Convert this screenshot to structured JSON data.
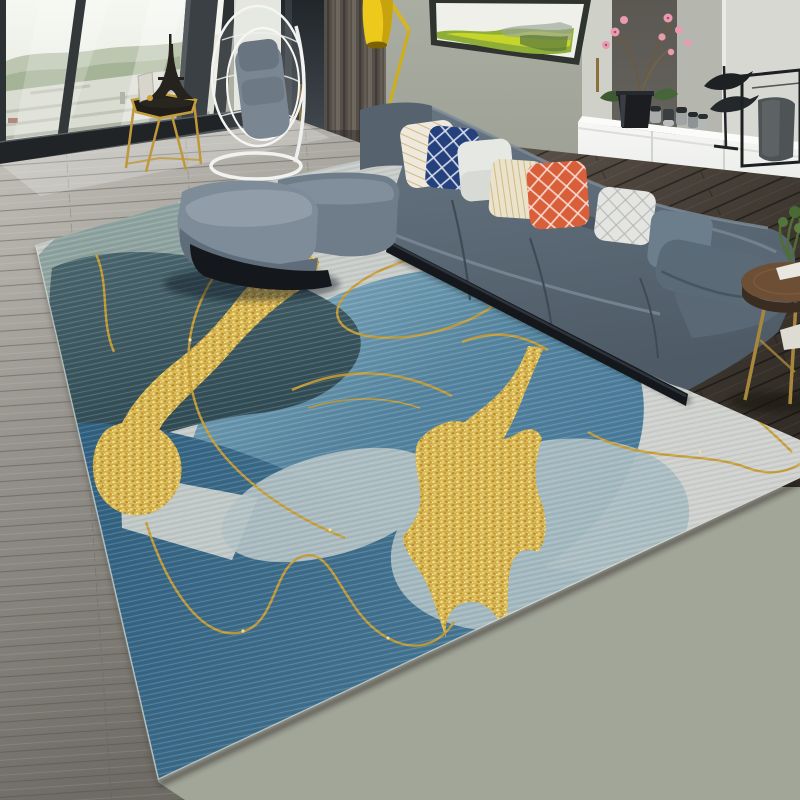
{
  "meta": {
    "title": "Living room product photo — abstract blue and gold area rug",
    "description": "Photographic scene: grey L-shaped sectional sofa on a diagonal abstract rug, floor-to-ceiling window with city view, white sideboard, yellow floor lamp, hanging egg chair"
  },
  "scene": {
    "objects": [
      "window city view",
      "gold hexagonal side table",
      "eiffel tower figurine",
      "hanging egg chair",
      "dark curtain",
      "yellow floor lamp",
      "wall art canvas",
      "white sideboard",
      "pink orchid",
      "ceramic cups",
      "bird sculpture",
      "metal cube vase stand",
      "grey sectional sofa",
      "throw pillows",
      "chaise cushions",
      "round walnut side table",
      "abstract area rug",
      "grey wood floor",
      "dark wood floor"
    ],
    "counts": {
      "throw_pillows": 8,
      "cups_on_sideboard": 5,
      "bird_figurines": 2,
      "window_mullions": 3,
      "chaise_cushions": 2
    }
  },
  "rug": {
    "style": "abstract modern",
    "shapes": [
      "sage blob",
      "dark teal blob",
      "azure circle",
      "pale lens",
      "bright wedge",
      "pale disc",
      "deep blue field"
    ],
    "accents": [
      "glitter gold ribbon",
      "glitter gold star",
      "thin gold script lines"
    ]
  },
  "palette": {
    "wall": "#a4a89b",
    "wall_stripe_dark": "#6e695f",
    "wall_stripe_light": "#b5b7ae",
    "wall_panel_bright": "#d7d8d2",
    "door_white": "#cfd1c9",
    "curtain": "#55504a",
    "lamp_yellow": "#edc91c",
    "cabinet_white": "#f2f3f1",
    "sofa_base": "#5d6b79",
    "sofa_shadow": "#46525e",
    "sofa_highlight": "#82909d",
    "plinth_black": "#14171b",
    "chaise_top": "#7e8c99",
    "pillow_white": "#eee9dc",
    "pillow_navy": "#24407d",
    "pillow_grey": "#e6e8e4",
    "pillow_cream": "#eae2ca",
    "pillow_coral": "#d95f3a",
    "pillow_slate": "#6c7d8c",
    "pillow_lumbar": "#5a6a77",
    "rug_base": "#c8ccc9",
    "rug_sage": "#8ea39f",
    "rug_azure": "#5a8aa4",
    "rug_teal": "#3d5a63",
    "rug_deep_blue": "#32617f",
    "rug_pale": "#a9bdc2",
    "rug_wedge": "#ccd1cd",
    "gold_glitter": "#d7b34c",
    "gold_line": "#c79d35",
    "floor_light": "#9b9894",
    "floor_dark": "#4a423c",
    "table_wood": "#6d4f35",
    "metal_gold": "#bf983c",
    "orchid_pink": "#e89bb1",
    "foliage_green": "#8fae38"
  }
}
